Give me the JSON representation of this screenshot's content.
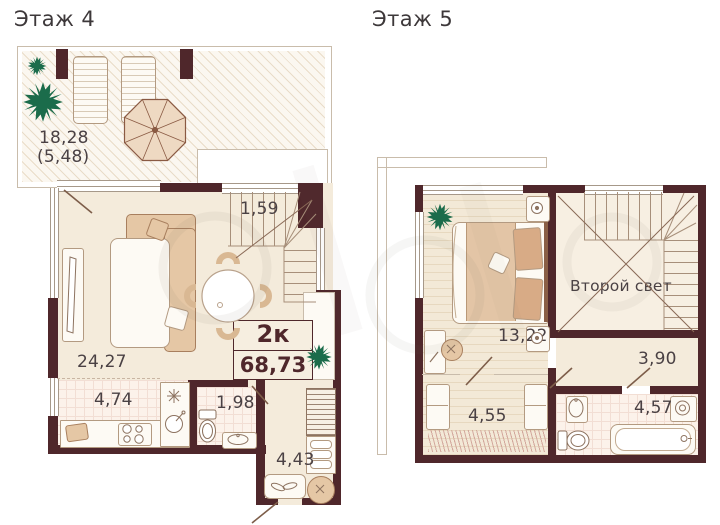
{
  "colors": {
    "wall": "#4f272b",
    "floor_cream": "#f4ebdb",
    "tile_pink": "#fcf2ea",
    "plant_green": "#1b6c4b",
    "furniture_beige": "#e5c7a5",
    "label_text": "#4a4144"
  },
  "floor4": {
    "title": "Этаж 4",
    "terrace": {
      "area": "18,28",
      "area_reduced": "(5,48)"
    },
    "rooms": {
      "living": "24,27",
      "stairs": "1,59",
      "kitchen": "4,74",
      "bathroom": "1,98",
      "hall": "4,43"
    },
    "summary": {
      "rooms_label": "2к",
      "total_area": "68,73"
    }
  },
  "floor5": {
    "title": "Этаж 5",
    "rooms": {
      "bedroom": "13,22",
      "void": "Второй свет",
      "corridor": "3,90",
      "wardrobe": "4,55",
      "bathroom": "4,57"
    }
  }
}
